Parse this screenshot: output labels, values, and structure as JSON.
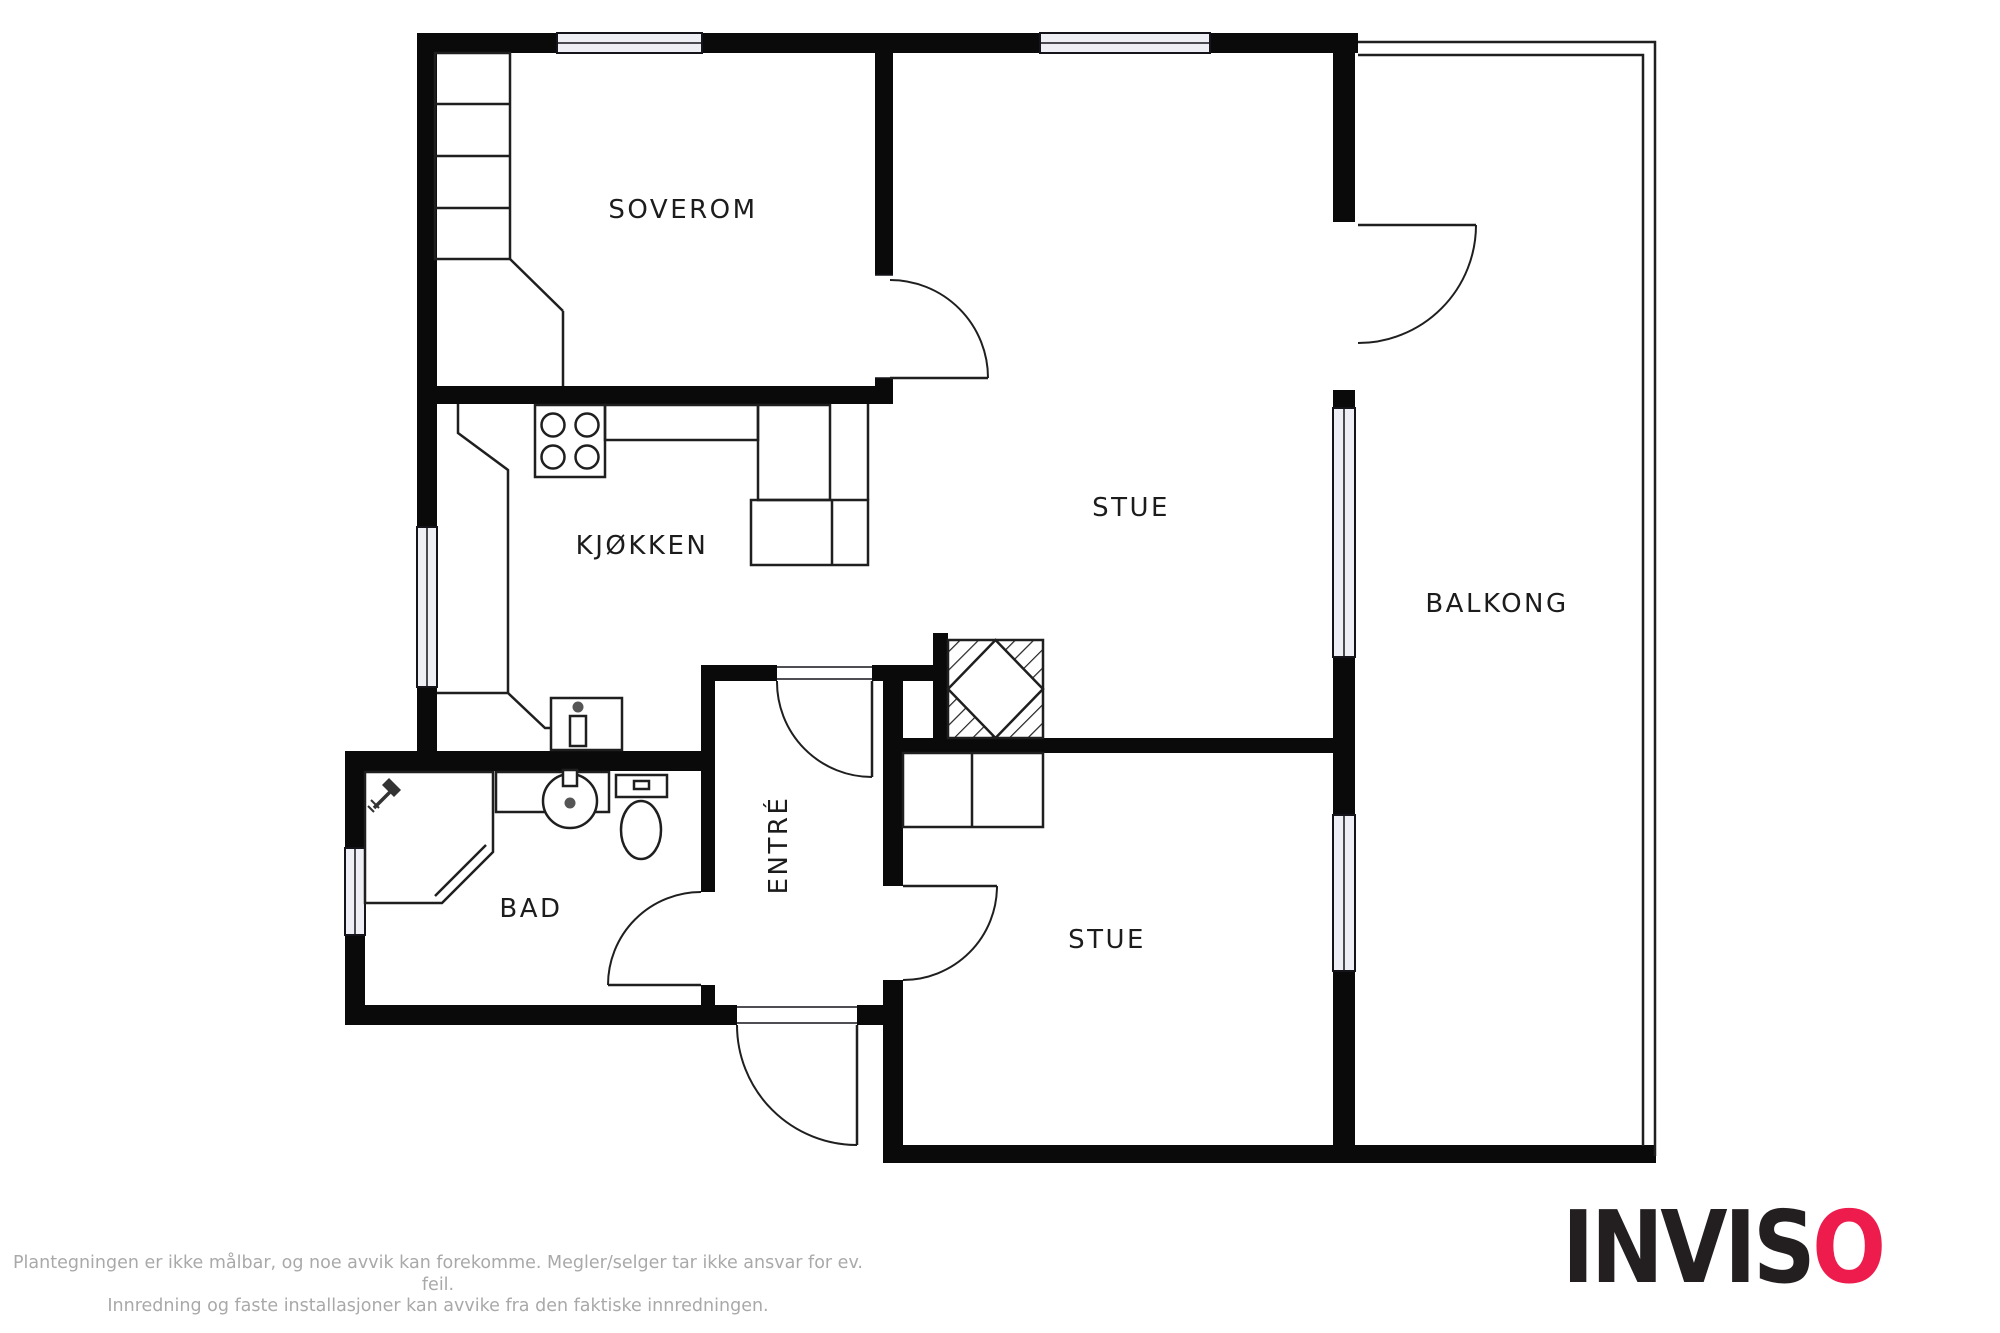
{
  "page": {
    "width": 2000,
    "height": 1333,
    "background": "#ffffff",
    "type": "floor-plan"
  },
  "floorplan": {
    "rooms": [
      {
        "id": "soverom",
        "label": "SOVEROM",
        "label_x": 683,
        "label_y": 218
      },
      {
        "id": "stue-top",
        "label": "STUE",
        "label_x": 1131,
        "label_y": 516
      },
      {
        "id": "balkong",
        "label": "BALKONG",
        "label_x": 1497,
        "label_y": 612
      },
      {
        "id": "kjokken",
        "label": "KJØKKEN",
        "label_x": 642,
        "label_y": 554
      },
      {
        "id": "bad",
        "label": "BAD",
        "label_x": 531,
        "label_y": 917
      },
      {
        "id": "entre",
        "label": "ENTRÉ",
        "label_x": 778,
        "label_y": 845,
        "rotation": -90
      },
      {
        "id": "stue-bottom",
        "label": "STUE",
        "label_x": 1107,
        "label_y": 948
      }
    ],
    "fixtures": [
      "wardrobe",
      "stove-4-burners",
      "kitchen-counter",
      "kitchen-sink",
      "shower-cabin",
      "shower-head",
      "washbasin",
      "toilet",
      "chimney-shaft",
      "sideboard-cabinet"
    ],
    "doors": [
      "soverom-to-stue",
      "stue-to-balkong",
      "kjokken-to-entre",
      "entre-to-bad",
      "entre-to-stue",
      "main-entrance"
    ],
    "window_count": 6,
    "colors": {
      "wall": "#0a0a0a",
      "line": "#1f1f1f",
      "window_fill": "#edeff5"
    }
  },
  "footer": {
    "disclaimer_line1": "Plantegningen er ikke målbar, og noe avvik kan forekomme. Megler/selger tar ikke ansvar for ev. feil.",
    "disclaimer_line2": "Innredning og faste installasjoner kan avvike fra den faktiske innredningen.",
    "disclaimer_color": "#a9a9a9",
    "logo_text_black": "INVIS",
    "logo_text_red": "O",
    "logo_black_color": "#231f20",
    "logo_red_color": "#ee1b4d"
  }
}
